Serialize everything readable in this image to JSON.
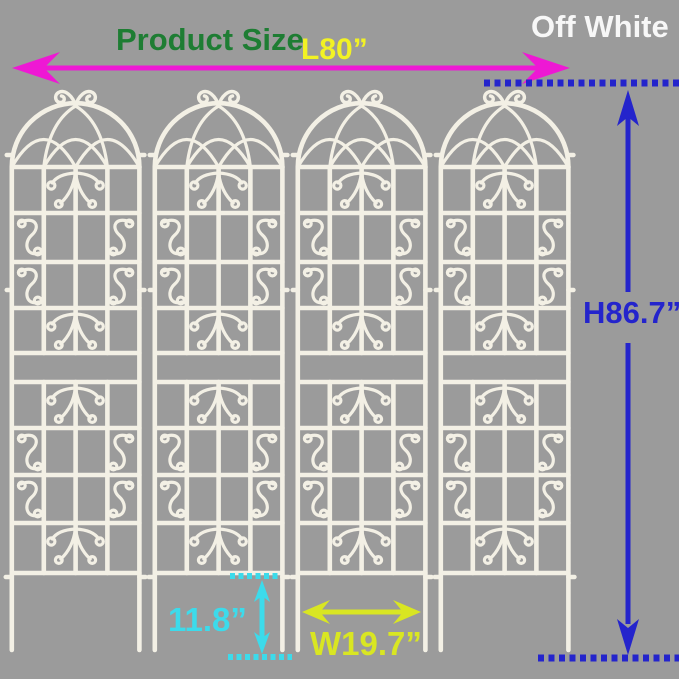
{
  "header": {
    "product_size_label": "Product Size",
    "color_name": "Off White"
  },
  "dimensions": {
    "length": "L80”",
    "height": "H86.7”",
    "width": "W19.7”",
    "ground_depth": "11.8”"
  },
  "product": {
    "panel_count": 4
  },
  "colors": {
    "bg": "#9b9b9b",
    "trellis": "#f3f0e5",
    "green": "#1e7d33",
    "yellow": "#f2f224",
    "magenta": "#ee18d4",
    "blue": "#2424cc",
    "cyan": "#3cdbeb",
    "lime": "#d9e622",
    "white": "#f7f7f7"
  }
}
